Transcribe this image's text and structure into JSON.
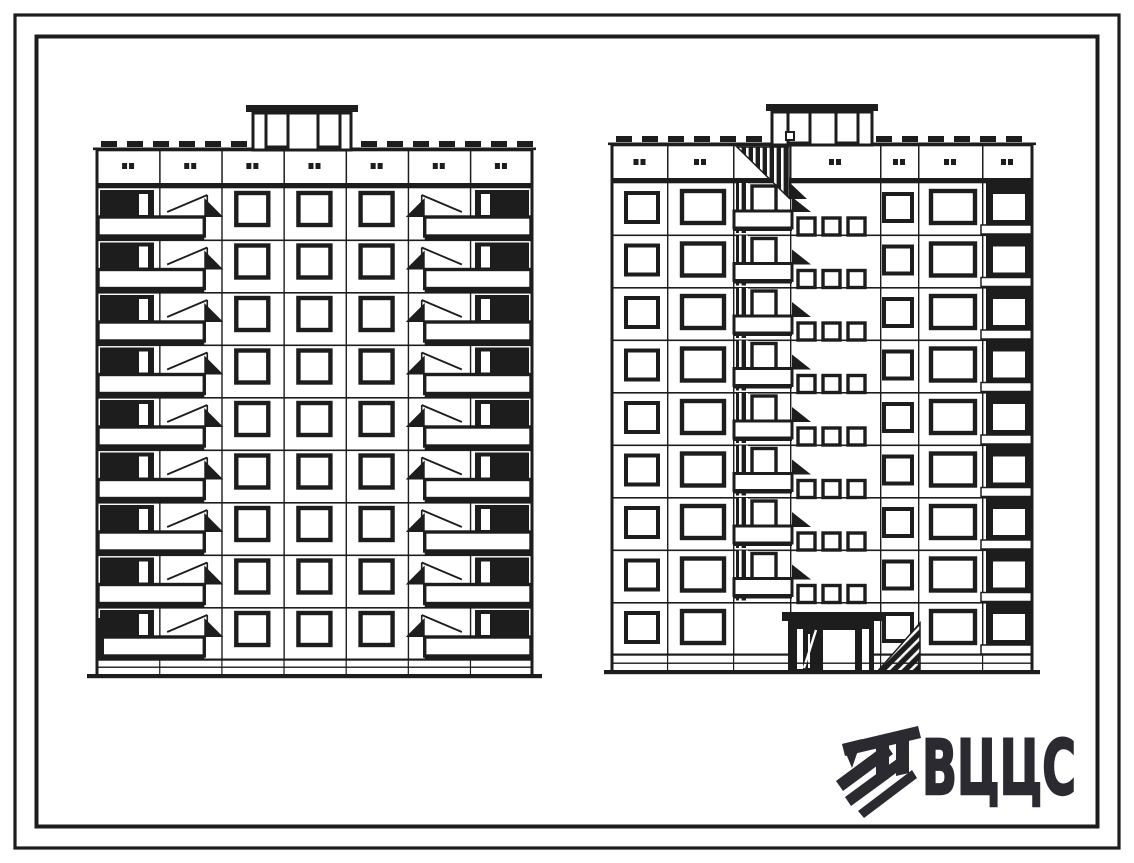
{
  "page": {
    "paper": "#ffffff",
    "ink": "#1d1d1d"
  },
  "logo": {
    "text": "ВЦЦС"
  },
  "drawing": {
    "type": "panel-apartment-building-elevations",
    "floors": 9,
    "parapet_panels": 7,
    "elevations": [
      {
        "position": "left",
        "balcony_stacks": 2,
        "window_columns": 3,
        "roof_penthouse_doors": 2
      },
      {
        "position": "right",
        "loggia_stacks": 2,
        "stair_window_groups": 8,
        "stair_windows_per_group": 3,
        "roof_penthouse_doors": 2,
        "has_entrance": true
      }
    ]
  }
}
